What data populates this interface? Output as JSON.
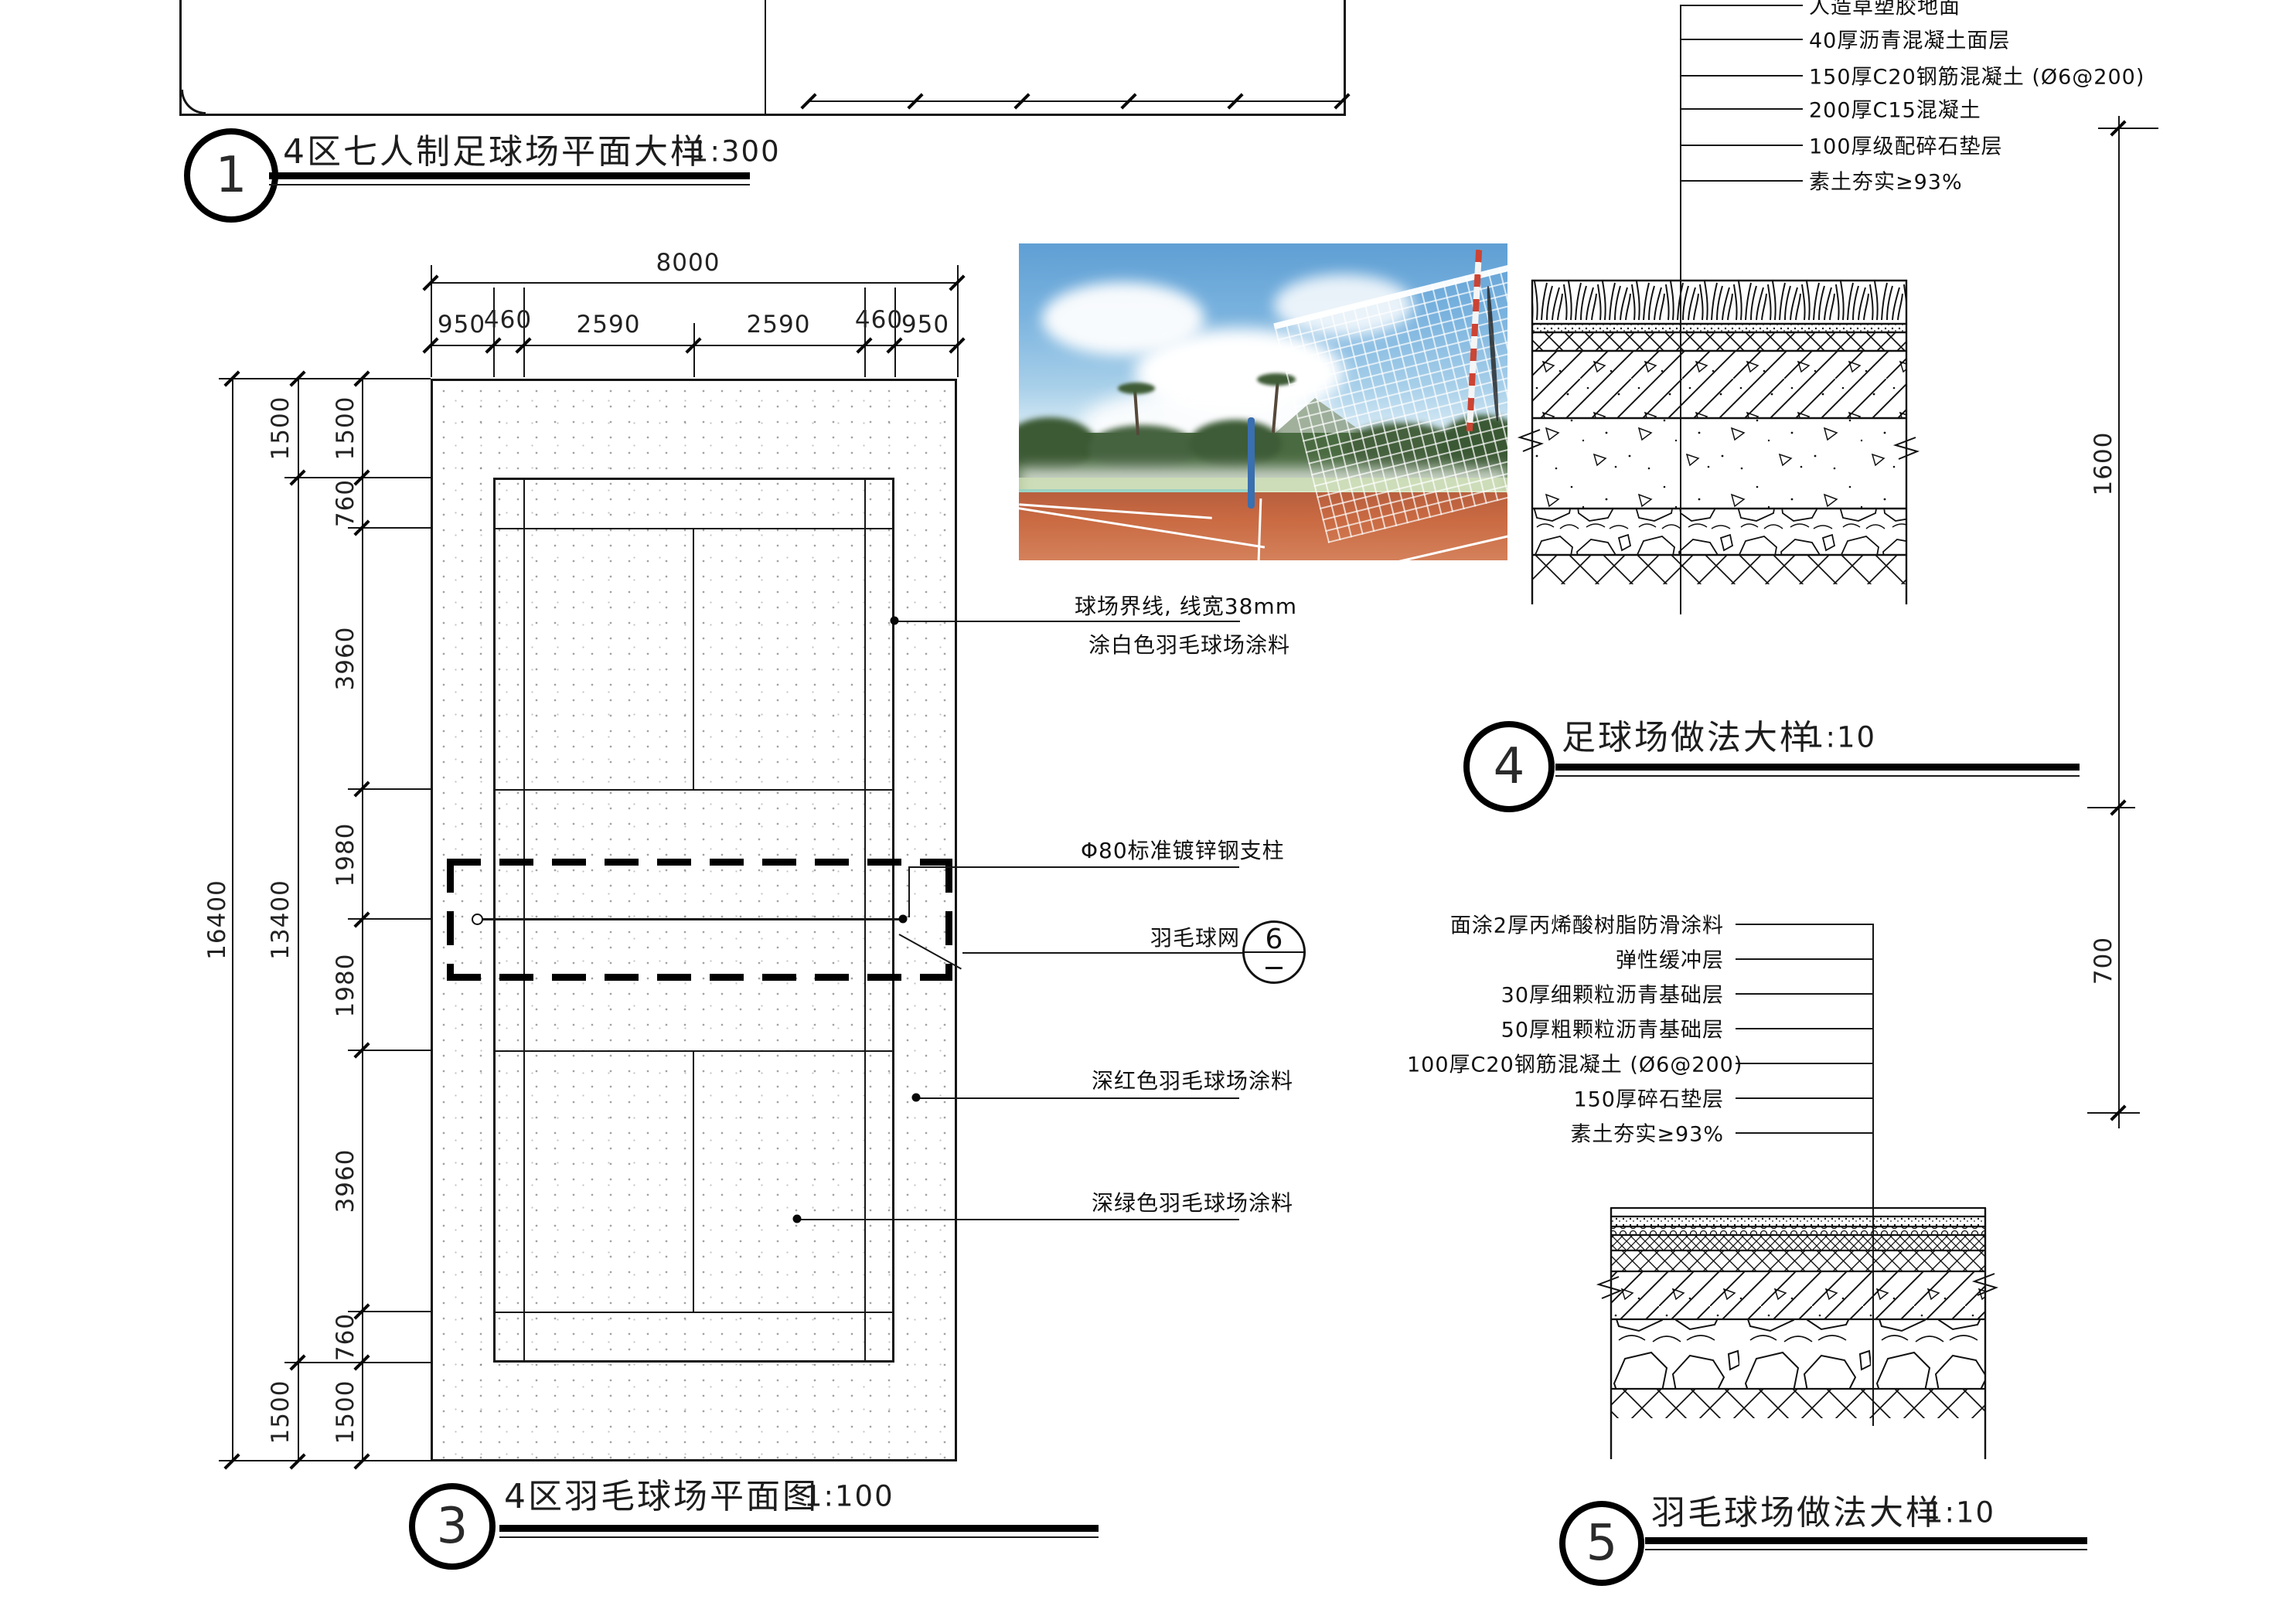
{
  "sheet": {
    "details": {
      "d1": {
        "bubble": "1",
        "title": "4区七人制足球场平面大样",
        "scale": "1:300"
      },
      "d3": {
        "bubble": "3",
        "title": "4区羽毛球场平面图",
        "scale": "1:100"
      },
      "d4": {
        "bubble": "4",
        "title": "足球场做法大样",
        "scale": "1:10"
      },
      "d5": {
        "bubble": "5",
        "title": "羽毛球场做法大样",
        "scale": "1:10"
      }
    }
  },
  "plan": {
    "dims_top": {
      "overall": "8000",
      "segments": [
        "950",
        "460",
        "2590",
        "2590",
        "460",
        "950"
      ]
    },
    "dims_left": {
      "overall": "16400",
      "outer_chain": [
        "1500",
        "13400",
        "1500"
      ],
      "segments": [
        "1500",
        "760",
        "3960",
        "1980",
        "1980",
        "3960",
        "760",
        "1500"
      ]
    },
    "callouts": {
      "court_line_1": "球场界线, 线宽38mm",
      "court_line_2": "涂白色羽毛球场涂料",
      "post": "Φ80标准镀锌钢支柱",
      "net": "羽毛球网",
      "net_ref_num": "6",
      "red_coating": "深红色羽毛球场涂料",
      "green_coating": "深绿色羽毛球场涂料"
    }
  },
  "soccer_section": {
    "layers": [
      "人造草塑胶地面",
      "40厚沥青混凝土面层",
      "150厚C20钢筋混凝土 (Ø6@200)",
      "200厚C15混凝土",
      "100厚级配碎石垫层",
      "素土夯实≥93%"
    ]
  },
  "badminton_section": {
    "layers": [
      "面涂2厚丙烯酸树脂防滑涂料",
      "弹性缓冲层",
      "30厚细颗粒沥青基础层",
      "50厚粗颗粒沥青基础层",
      "100厚C20钢筋混凝土 (Ø6@200)",
      "150厚碎石垫层",
      "素土夯实≥93%"
    ]
  },
  "ref_dims": {
    "right_upper": "1600",
    "right_lower": "700"
  }
}
